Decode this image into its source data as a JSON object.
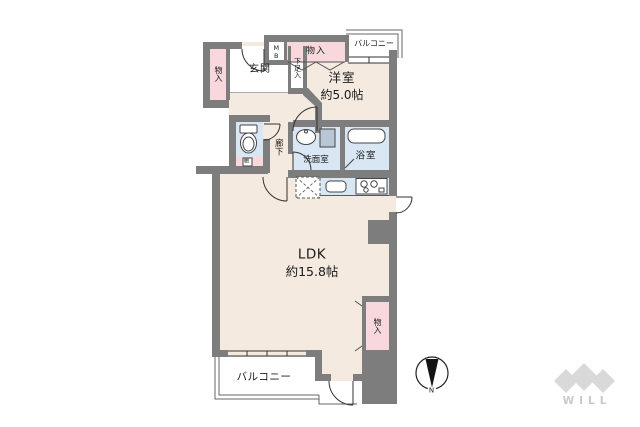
{
  "rooms": {
    "entrance": {
      "label": "玄関"
    },
    "shoe_storage": {
      "label": "下足入"
    },
    "closet_entrance": {
      "label": "物入"
    },
    "meter_box": {
      "label": "MB"
    },
    "closet_bedroom": {
      "label": "物入"
    },
    "balcony_top": {
      "label": "バルコニー"
    },
    "bedroom": {
      "label": "洋室",
      "area": "約5.0帖"
    },
    "corridor": {
      "label": "廊下"
    },
    "toilet_shelf": {
      "label": "棚"
    },
    "washroom": {
      "label": "洗面室"
    },
    "bathroom": {
      "label": "浴室"
    },
    "ldk": {
      "label": "LDK",
      "area": "約15.8帖"
    },
    "closet_ldk": {
      "label": "物入"
    },
    "balcony_bottom": {
      "label": "バルコニー"
    }
  },
  "compass": {
    "label": "N"
  },
  "brand": {
    "logo_text": "WILL"
  },
  "colors": {
    "wall": "#7d7d7d",
    "room_floor": "#f4eae0",
    "closet": "#f8d8dc",
    "wet_area": "#d8e7f3",
    "balcony": "#ffffff",
    "logo": "#d9d9d9"
  }
}
